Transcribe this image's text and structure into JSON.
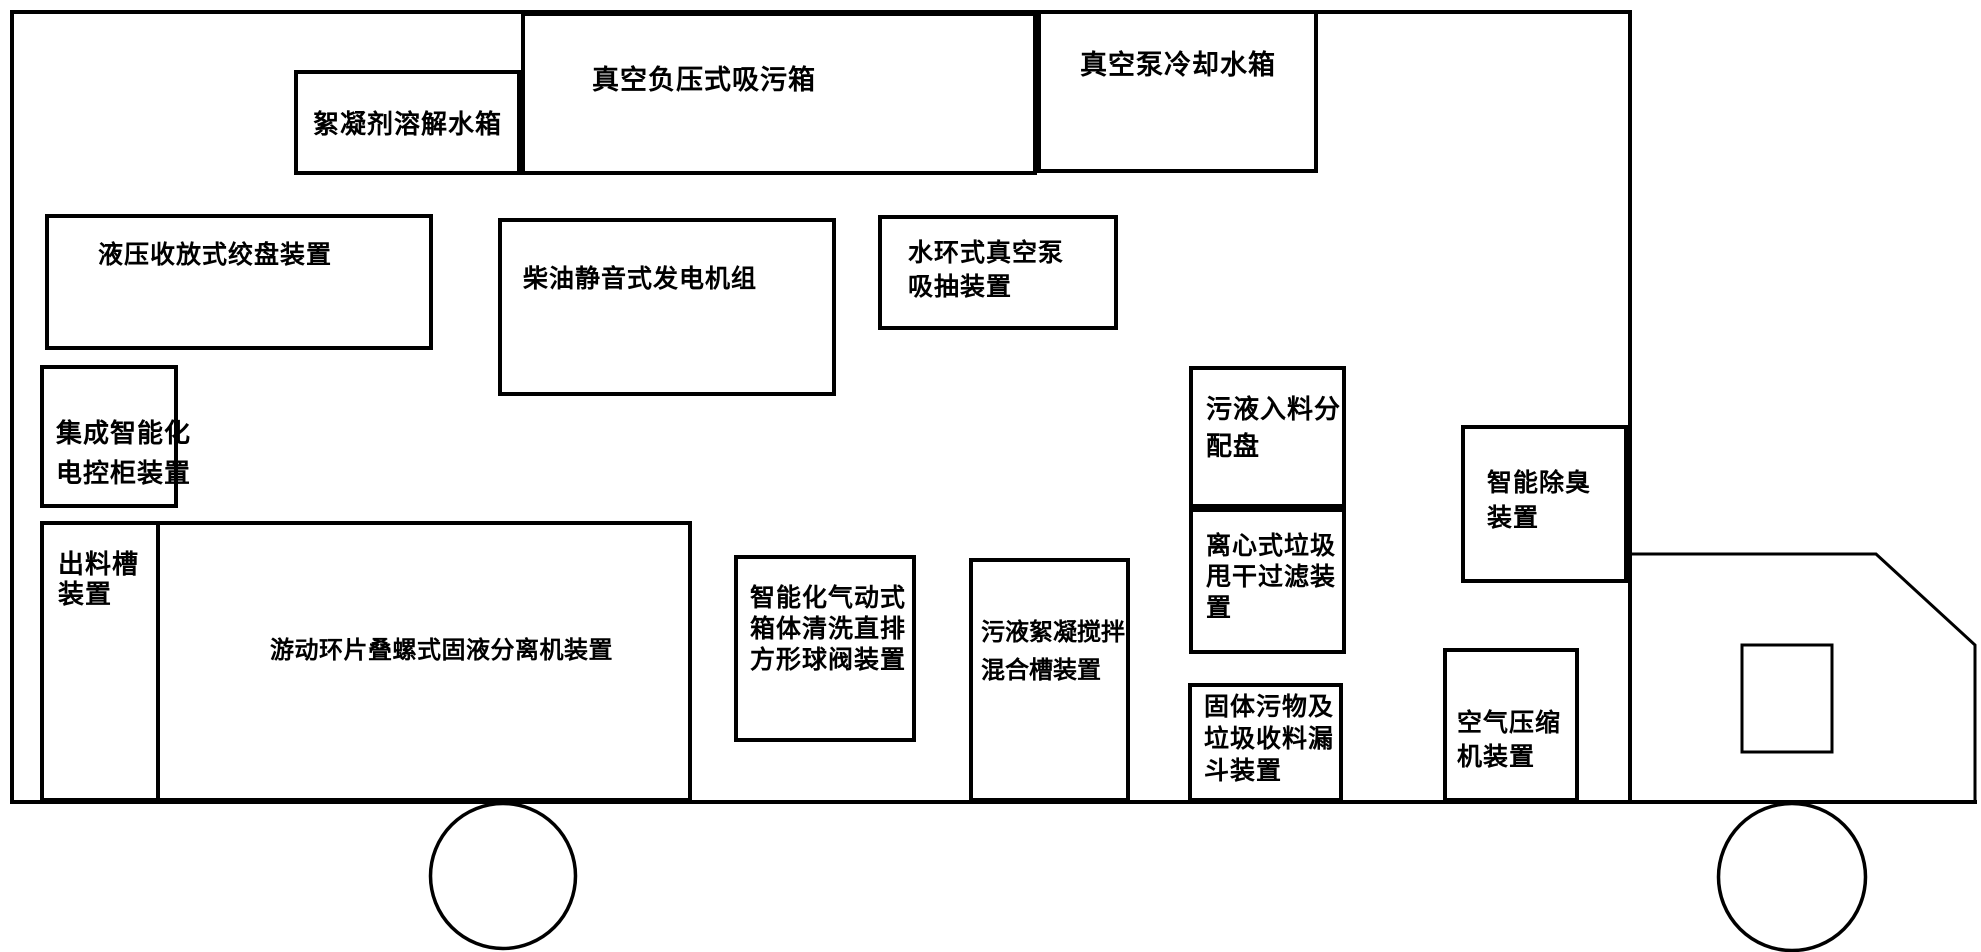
{
  "colors": {
    "ink": "#000000",
    "paper": "#ffffff"
  },
  "components": {
    "flocculant_tank": {
      "label": "絮凝剂溶解水箱"
    },
    "suction_tank": {
      "label": "真空负压式吸污箱"
    },
    "cooling_tank": {
      "label": "真空泵冷却水箱"
    },
    "winch": {
      "label": "液压收放式绞盘装置"
    },
    "generator": {
      "label": "柴油静音式发电机组"
    },
    "water_ring_pump": {
      "lines": [
        "水环式真空泵",
        "吸抽装置"
      ]
    },
    "control_cabinet": {
      "lines": [
        "集成智能化",
        "电控柜装置"
      ]
    },
    "discharge_chute": {
      "lines": [
        "出料槽",
        "装置"
      ]
    },
    "separator": {
      "label": "游动环片叠螺式固液分离机装置"
    },
    "pneumatic_valve": {
      "lines": [
        "智能化气动式",
        "箱体清洗直排",
        "方形球阀装置"
      ]
    },
    "mixing_tank": {
      "lines": [
        "污液絮凝搅拌",
        "混合槽装置"
      ]
    },
    "inlet_distributor": {
      "lines": [
        "污液入料分",
        "配盘"
      ]
    },
    "centrifugal_filter": {
      "lines": [
        "离心式垃圾",
        "甩干过滤装",
        "置"
      ]
    },
    "solids_hopper": {
      "lines": [
        "固体污物及",
        "垃圾收料漏",
        "斗装置"
      ]
    },
    "deodorizer": {
      "lines": [
        "智能除臭",
        "装置"
      ]
    },
    "air_compressor": {
      "lines": [
        "空气压缩",
        "机装置"
      ]
    }
  }
}
